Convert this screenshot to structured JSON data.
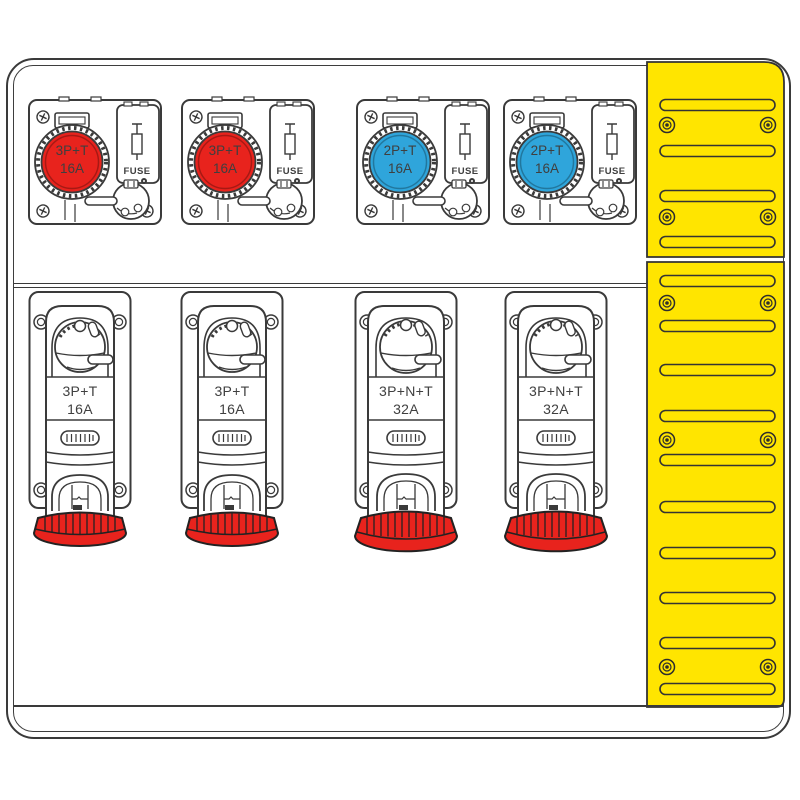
{
  "board": {
    "description_colors": {
      "outline": "#3a3a3a",
      "socket_red": "#e8231d",
      "socket_blue": "#2fa5db",
      "panel_yellow": "#ffe500",
      "background": "#ffffff"
    },
    "top_sockets": [
      {
        "line1": "3P+T",
        "line2": "16A",
        "fuse": "FUSE",
        "color": "#e8231d"
      },
      {
        "line1": "3P+T",
        "line2": "16A",
        "fuse": "FUSE",
        "color": "#e8231d"
      },
      {
        "line1": "2P+T",
        "line2": "16A",
        "fuse": "FUSE",
        "color": "#2fa5db"
      },
      {
        "line1": "2P+T",
        "line2": "16A",
        "fuse": "FUSE",
        "color": "#2fa5db"
      }
    ],
    "bottom_sockets": [
      {
        "line1": "3P+T",
        "line2": "16A",
        "cap_color": "#e8231d"
      },
      {
        "line1": "3P+T",
        "line2": "16A",
        "cap_color": "#e8231d"
      },
      {
        "line1": "3P+N+T",
        "line2": "32A",
        "cap_color": "#e8231d"
      },
      {
        "line1": "3P+N+T",
        "line2": "32A",
        "cap_color": "#e8231d"
      }
    ]
  }
}
